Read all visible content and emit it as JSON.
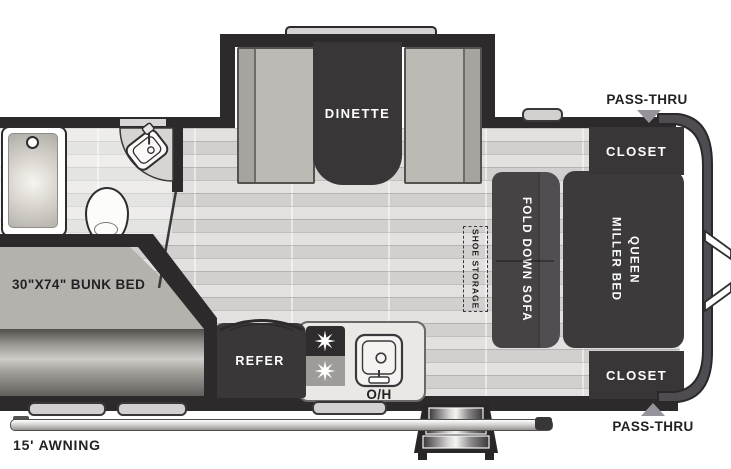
{
  "floorplan": {
    "slideout": {
      "dinette": "DINETTE"
    },
    "bedroom": {
      "closet_top": "CLOSET",
      "closet_bottom": "CLOSET",
      "bed_line1": "QUEEN",
      "bed_line2": "MILLER BED",
      "sofa": "FOLD DOWN SOFA",
      "pass_thru_top": "PASS-THRU",
      "pass_thru_bottom": "PASS-THRU"
    },
    "storage": {
      "shoe": "SHOE STORAGE"
    },
    "bunk": {
      "label": "30\"X74\" BUNK BED"
    },
    "kitchen": {
      "refer": "REFER",
      "overhead": "O/H"
    },
    "exterior": {
      "awning": "15' AWNING"
    },
    "colors": {
      "wall": "#2d2a2c",
      "furniture_dark": "#3d3a3c",
      "sofa": "#474345",
      "bench": "#bcbab5",
      "floor": "#dcdbd9",
      "bunk_top": "#b5b2ad",
      "pass_thru_arrow": "#96949a",
      "label_text": "#232124",
      "label_text_light": "#ffffff"
    }
  }
}
